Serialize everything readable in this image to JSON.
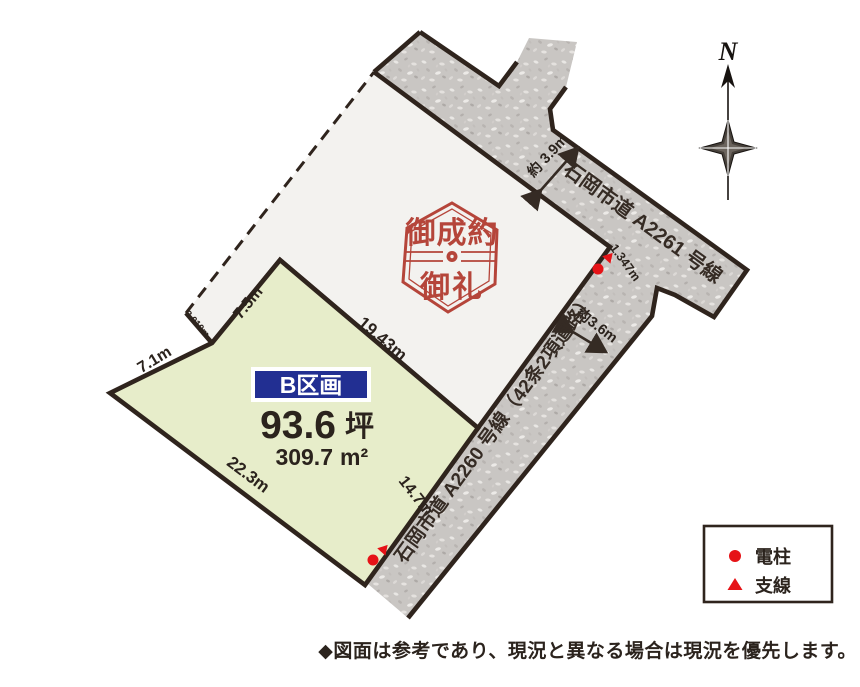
{
  "map": {
    "plot_b": {
      "badge": "B区画",
      "area_tsubo": "93.6",
      "tsubo_unit": "坪",
      "area_sqm": "309.7",
      "sqm_unit": "m²"
    },
    "stamp": {
      "line1": "御成約",
      "line2": "御礼"
    },
    "dims": {
      "d75": "7.5m",
      "d71": "7.1m",
      "d3010": "3.010m",
      "d1943": "19.43m",
      "d223": "22.3m",
      "d147": "14.7m",
      "d1347": "1.347m",
      "w39": "約 3.9m",
      "w36": "約3.6m"
    },
    "roads": {
      "a2261": "石岡市道 A2261 号線",
      "a2260": "石岡市道 A2260 号線（42条2項道路）"
    },
    "compass": {
      "label": "N"
    },
    "legend": {
      "pole": "電柱",
      "wire": "支線"
    },
    "note": "◆図面は参考であり、現況と異なる場合は現況を優先します。"
  },
  "colors": {
    "road_fill": "#c9c6c3",
    "outline": "#2f241d",
    "plot_a_fill": "#f3f2ef",
    "plot_b_fill": "#e7edca",
    "badge_bg": "#222f92",
    "badge_text": "#ffffff",
    "stamp_red": "#b5453a",
    "marker_red": "#e61317",
    "text_dark": "#2b231d"
  }
}
